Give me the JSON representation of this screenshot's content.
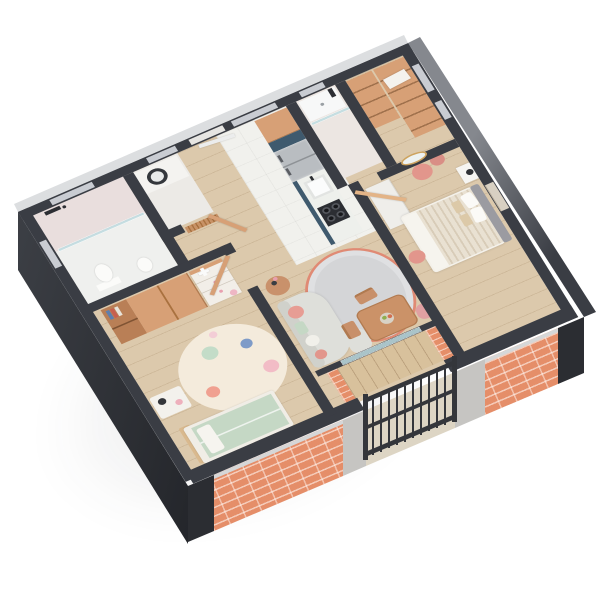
{
  "image": {
    "type": "3d-floor-plan-render",
    "style": "isometric dollhouse cutaway of a one-bedroom apartment with kids room",
    "background": "white",
    "camera": "aerial view from the south-west"
  },
  "palette": {
    "bg": "#ffffff",
    "wall": "#3a3d44",
    "wallDark": "#2b2d32",
    "slabLight": "#c6c5c2",
    "faceNE": "#85888e",
    "faceNW": "#dcdee0",
    "brick": "#e58e69",
    "woodFloor": "#dcc9ac",
    "deck": "#d8c19c",
    "tileWhite": "#f1f1ed",
    "tilePink": "#e9dedd",
    "cabinetWood": "#d7a076",
    "cabinetWoodDark": "#b97f56",
    "navy": "#3f5a6e",
    "steel": "#b9bdc1",
    "white": "#f2f1ed",
    "glass": "#cfe3e6",
    "sofa": "#dedfda",
    "rug": "#d4d5d7",
    "coral": "#e08a74",
    "pink": "#e2968c",
    "pinkLight": "#f2bcc6",
    "mint": "#c5d8c5",
    "blue": "#7e9bc8",
    "bedStripe": "#e9e1d2",
    "bedStripe2": "#d8ccb8",
    "headboard": "#9b9ba1",
    "tan": "#d9b98e",
    "gold": "#cda35f",
    "dark": "#2c2e33",
    "railing": "#34363b",
    "kidsRug": "#f4ebdc"
  },
  "rooms": [
    {
      "id": "bathroom",
      "label": "Bathroom",
      "items": [
        "walk-in shower",
        "glass partition",
        "black shower fixture",
        "pink tiled walls",
        "toilet",
        "washbasin"
      ]
    },
    {
      "id": "laundry",
      "label": "Laundry room",
      "items": [
        "washing machine under white counter",
        "wood slat screen",
        "wooden door"
      ]
    },
    {
      "id": "hallway",
      "label": "Entry hallway",
      "items": [
        "front door"
      ]
    },
    {
      "id": "kitchen",
      "label": "Kitchen",
      "items": [
        "tall wood cabinet",
        "navy tall unit",
        "fridge",
        "white counter with sink",
        "dark cooktop",
        "navy base fronts",
        "white tiled floor"
      ]
    },
    {
      "id": "shower-room",
      "label": "Shower room",
      "items": [
        "white shower tray",
        "glass screen",
        "black shower set"
      ]
    },
    {
      "id": "closet",
      "label": "Walk-in closet",
      "items": [
        "open wood shelving",
        "white storage box"
      ]
    },
    {
      "id": "bedroom",
      "label": "Bedroom",
      "items": [
        "double bed with striped beige duvet",
        "gray headboard",
        "white nightstand with black lamp",
        "oval gold mirror",
        "two pink poufs",
        "white wardrobe",
        "wall art",
        "wooden door"
      ]
    },
    {
      "id": "kids-room",
      "label": "Kids room",
      "items": [
        "wood wardrobe with open book shelves",
        "white dresser with toy plane",
        "round polka-dot rug",
        "kids bed with mint bedding",
        "white side table with lamp",
        "wooden door"
      ]
    },
    {
      "id": "living",
      "label": "Living / dining room",
      "items": [
        "curved gray sofa with pink and mint cushions",
        "gray rug with wavy coral border",
        "round wood side table with flowers",
        "wood dining table with fruit bowl",
        "two wood chairs",
        "pink chair"
      ]
    },
    {
      "id": "balcony",
      "label": "Balcony",
      "items": [
        "dark metal railing with balusters",
        "brick parapet walls",
        "wood deck"
      ]
    }
  ],
  "exterior": {
    "walls": "dark charcoal cutaway walls",
    "facade_accents": [
      "salmon brick sections with light mortar",
      "light gray concrete piers",
      "metal handrail over brick parapet"
    ],
    "ground": "soft drop shadow on white"
  }
}
